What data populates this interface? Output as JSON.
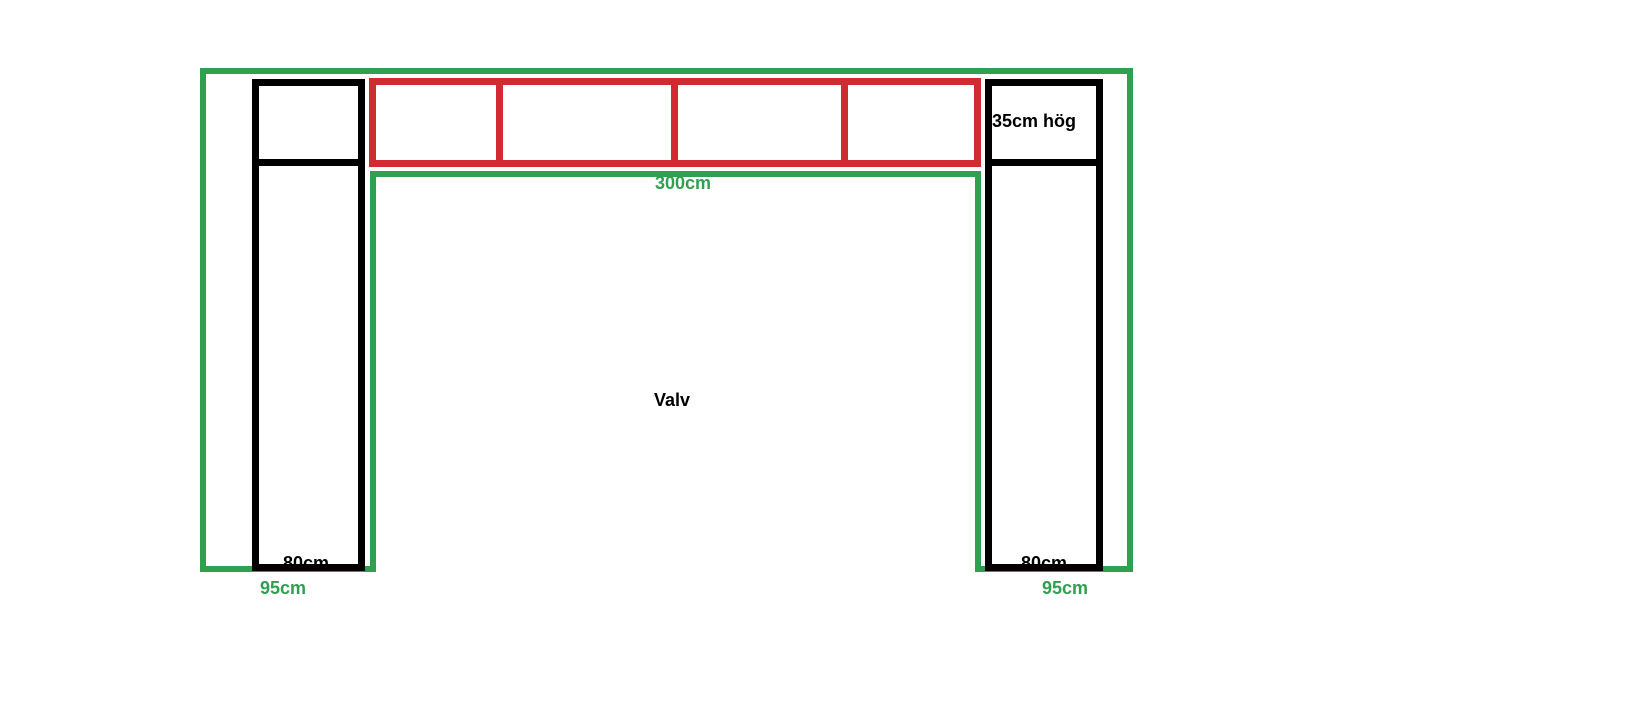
{
  "diagram": {
    "title": "arch-measurement-sketch",
    "colors": {
      "outline_green": "#2FA050",
      "shelf_red": "#CF2B30",
      "wall_black": "#000000",
      "background": "#FFFFFF"
    },
    "labels": {
      "shelf_height": "35cm hög",
      "span_width": "300cm",
      "opening_name": "Valv",
      "left_pillar_width": "80cm",
      "left_total_width": "95cm",
      "right_pillar_width": "80cm",
      "right_total_width": "95cm"
    },
    "shelf_section_count": 4
  }
}
